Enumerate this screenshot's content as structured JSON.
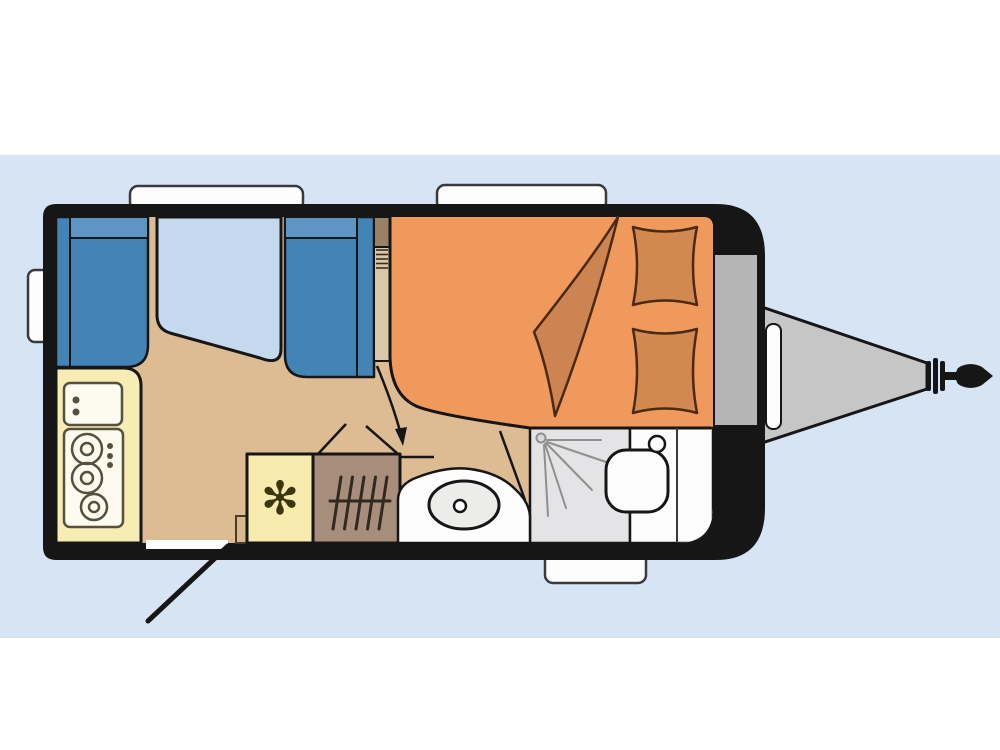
{
  "scene": {
    "type": "caravan-floor-plan",
    "description": "Top-view schematic floor plan of a single-axle travel caravan on a light blue canvas"
  },
  "glyphs": {
    "snowflake": "✻"
  },
  "colors": {
    "page": "#ffffff",
    "canvas": "#d7e4f4",
    "body": "#161616",
    "floor": "#ddbb93",
    "bench_seat": "#4484b5",
    "bench_back": "#5e95c2",
    "table": "#c4d9ed",
    "kitchen": "#f6ecb4",
    "appliance": "#fdfaf0",
    "appliance_detail": "#56503c",
    "fridge": "#f7ebad",
    "snowflake": "#3b3510",
    "heater": "#a78d7b",
    "divider": "#d8c8a7",
    "divider_cap": "#9a8166",
    "bed": "#f0995c",
    "bedding": "#d28951",
    "blanket": "#cc8450",
    "shower": "#e4e4e6",
    "washroom": "#fcfcfc",
    "basin": "#ececea",
    "white": "#fdfdfd",
    "locker": "#b5b5b5",
    "drawbar": "#c6c6c6",
    "step": "#d8b88f"
  },
  "features": {
    "body": "caravan body shell",
    "dinette": "front dinette with two facing bench seats and table",
    "kitchen": "kitchen block with sink unit and 3-burner hob",
    "fridge": "refrigerator with snowflake symbol",
    "heater": "heater with grille",
    "wardrobe": "wardrobe opening indication with arrow",
    "bed": "rear double bed with two pillows and folded blanket",
    "washroom": "washroom with shower cubicle, washbasin and toilet",
    "entrance": "entrance door with open swing line",
    "windows": [
      "front-left window",
      "front-right window",
      "left side window",
      "rear bottom window"
    ],
    "drawbar": "A-frame drawbar with hitch coupling",
    "gas_locker": "front gas bottle locker"
  }
}
